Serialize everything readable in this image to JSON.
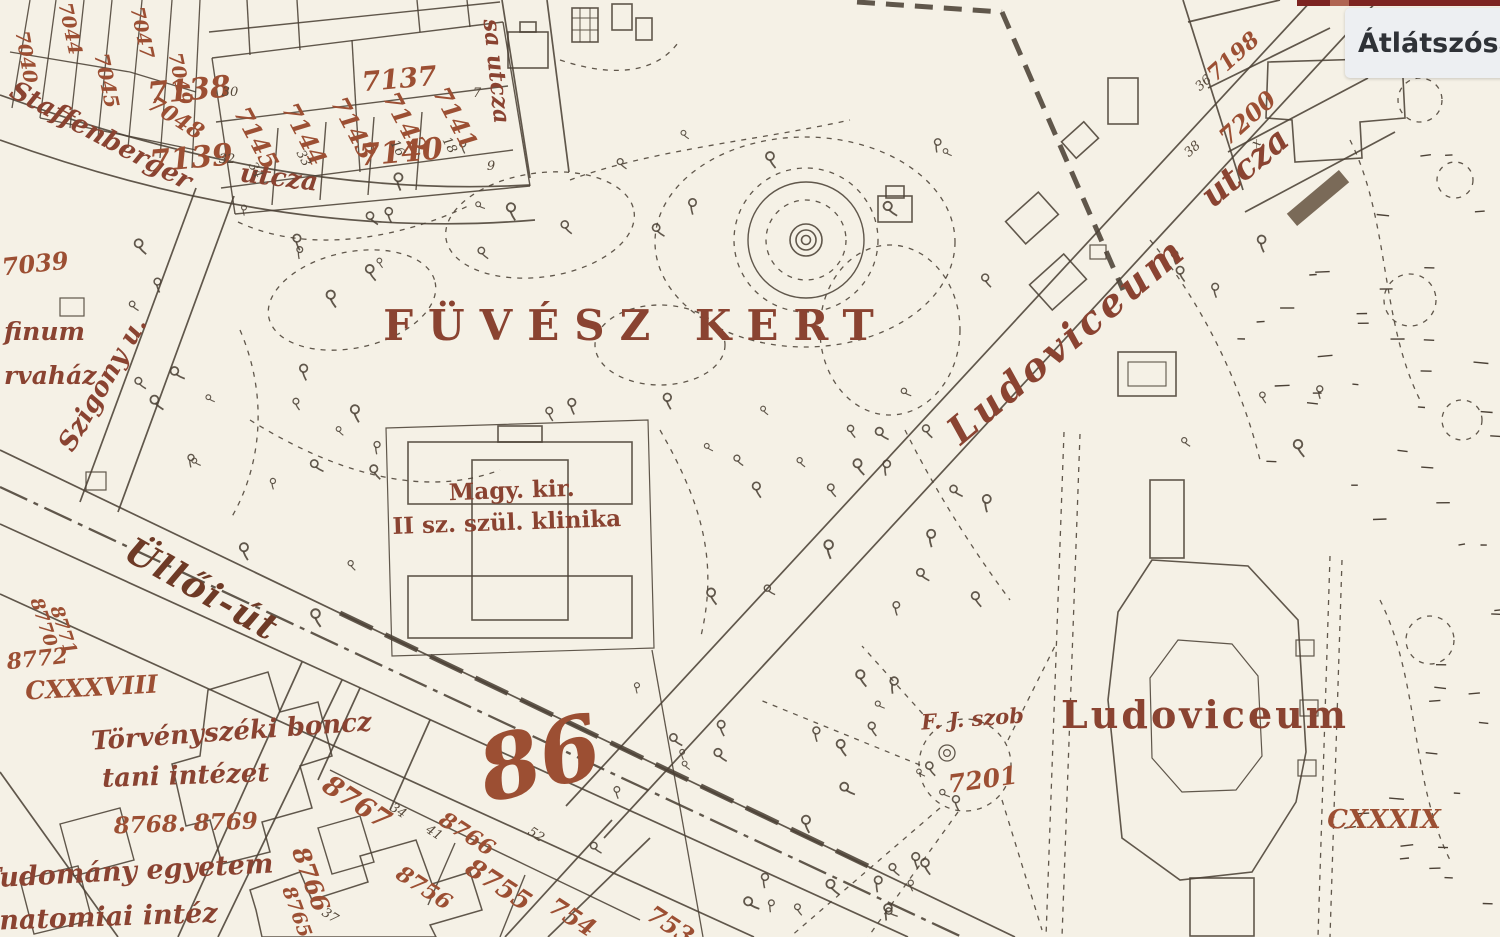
{
  "ui": {
    "transparency_label": "Átlátszóság"
  },
  "theme": {
    "paper": "#f5f1e6",
    "ink": "#4b4136",
    "number-red": "#9c4f33",
    "label-brown": "#8a4331",
    "dark-label": "#6e3a26",
    "panel-bg": "#edeff2",
    "panel-text": "#2f3237",
    "accent-bar": "#7d2421"
  },
  "map": {
    "garden_title": "FÜVÉSZ KERT",
    "road_marker": "86",
    "streets": {
      "ulloi": "Üllői-út",
      "szigony": "Szigony u.",
      "staffenberger": "Staffenberger",
      "staffenberger_suffix": "utcza",
      "side_street": "sa utcza",
      "ludoviceum": "Ludoviceum",
      "ludoviceum_suffix": "utcza"
    },
    "places": {
      "klinika_line1": "Magy. kir.",
      "klinika_line2": "II sz. szül. klinika",
      "ludoviceum_building": "Ludoviceum",
      "forensic_line1": "Törvényszéki boncz",
      "forensic_line2": "tani intézet",
      "university_line1": "Tudomány egyetem",
      "university_line2": "anatomiai intéz",
      "statue": "F. J. szob",
      "jozefinum_fragment": "finum",
      "orphanage_fragment": "rvaház",
      "block_cxxxviii": "CXXXVIII",
      "block_cxxxix": "CXXXIX"
    },
    "parcels": [
      "7138",
      "7137",
      "7139",
      "7140",
      "7141",
      "7142",
      "7143",
      "7144",
      "7145",
      "7039",
      "7040",
      "7044",
      "7045",
      "7047",
      "7048",
      "7049",
      "7198",
      "7200",
      "8767",
      "8766",
      "8766",
      "8765",
      "8756",
      "8755",
      "754",
      "753",
      "8768. 8769",
      "8770",
      "8771",
      "8772",
      "7201"
    ],
    "small_numbers": [
      "30",
      "32",
      "7",
      "9",
      "18",
      "16",
      "34",
      "33",
      "36",
      "38",
      "x",
      "41",
      "34",
      "37",
      "52"
    ]
  }
}
